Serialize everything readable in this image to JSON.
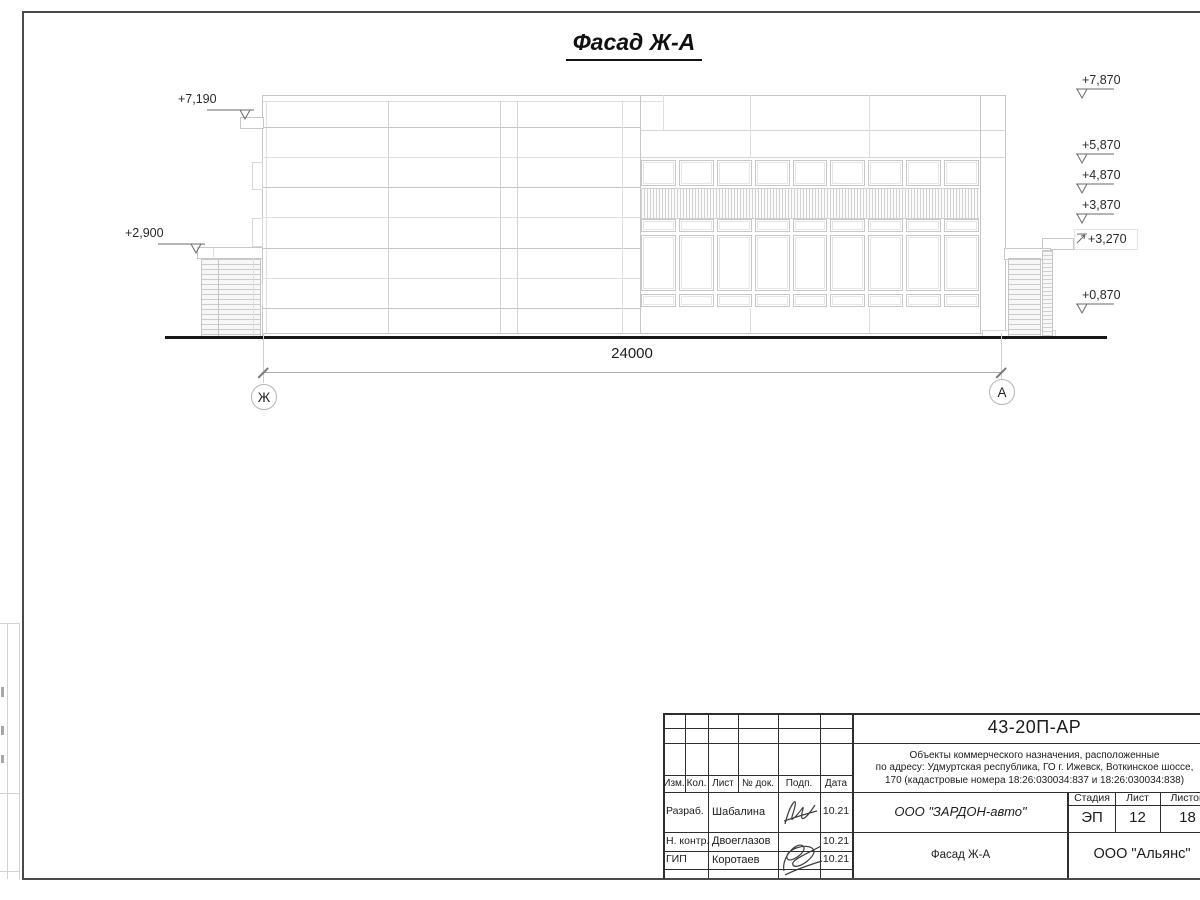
{
  "drawing": {
    "title": "Фасад Ж-А",
    "total_dimension": "24000",
    "axes": {
      "left": "Ж",
      "right": "А"
    },
    "elevations_left": [
      "+7,190",
      "+2,900"
    ],
    "elevations_right": [
      "+7,870",
      "+5,870",
      "+4,870",
      "+3,870",
      "+3,270",
      "+0,870"
    ]
  },
  "titleblock": {
    "doc_number": "43-20П-АР",
    "project_name_lines": [
      "Объекты коммерческого назначения, расположенные",
      "по адресу: Удмуртская республика, ГО г. Ижевск, Воткинское шоссе,",
      "170 (кадастровые номера 18:26:030034:837 и 18:26:030034:838)"
    ],
    "col_headers": {
      "izm": "Изм.",
      "kol": "Кол.",
      "list": "Лист",
      "doc": "№ док.",
      "podp": "Подп.",
      "data": "Дата"
    },
    "signature_rows": [
      {
        "role": "Разраб.",
        "name": "Шабалина",
        "date": "10.21"
      },
      {
        "role": "Н. контр.",
        "name": "Двоеглазов",
        "date": "10.21"
      },
      {
        "role": "ГИП",
        "name": "Коротаев",
        "date": "10.21"
      }
    ],
    "stage_header": "Стадия",
    "sheet_header": "Лист",
    "sheets_header": "Листов",
    "stage": "ЭП",
    "sheet": "12",
    "sheets": "18",
    "customer": "ООО \"ЗАРДОН-авто\"",
    "sheet_title": "Фасад Ж-А",
    "contractor": "ООО \"Альянс\""
  }
}
